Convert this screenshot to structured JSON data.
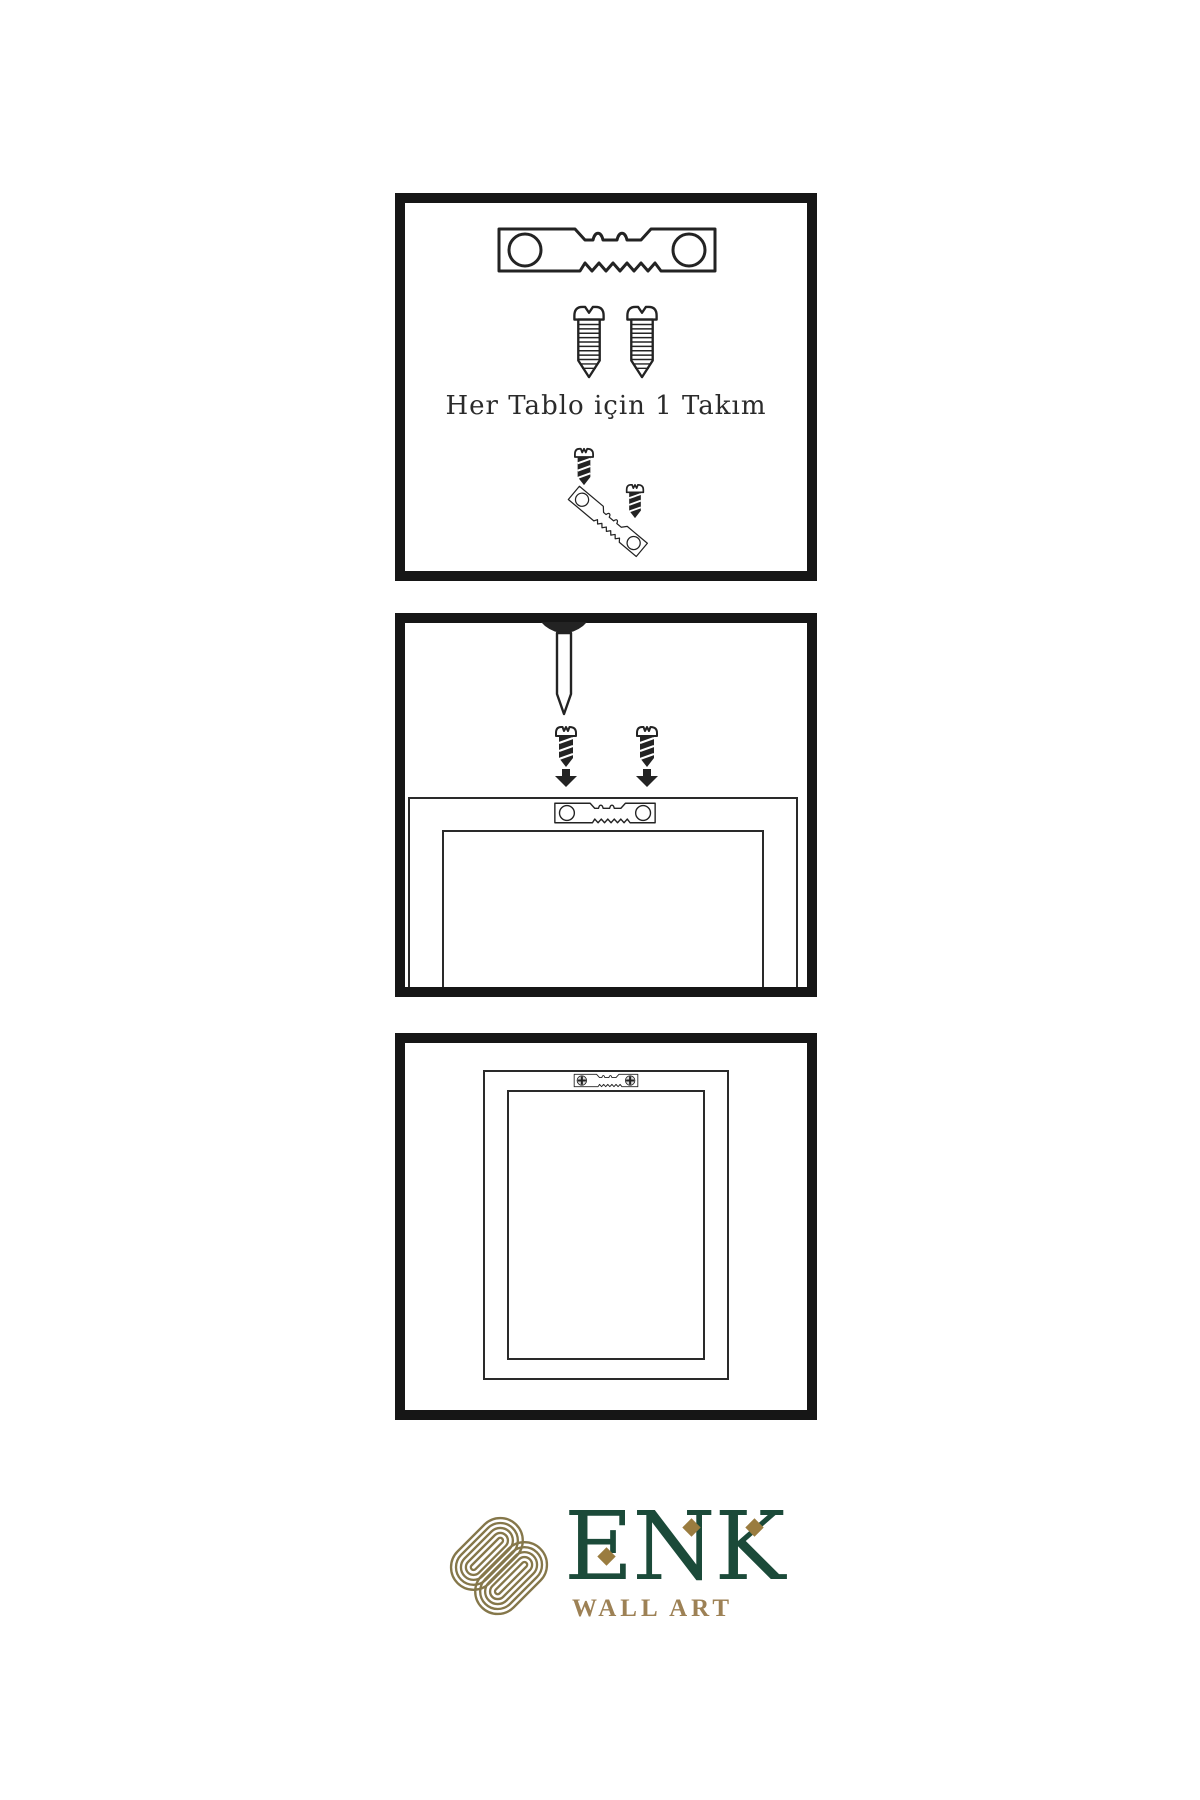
{
  "document": {
    "background_color": "#ffffff",
    "line_color": "#232323",
    "type": "wall-art hanging instruction sheet"
  },
  "panel_1": {
    "caption": "Her Tablo için 1 Takım",
    "icons": [
      "sawtooth-hanger-icon",
      "screw-icon",
      "screw-icon",
      "screw-icon",
      "angled-sawtooth-hanger-icon",
      "screw-icon"
    ]
  },
  "panel_2": {
    "icons": [
      "wall-nail-icon",
      "screw-icon",
      "screw-icon",
      "down-arrow-icon",
      "down-arrow-icon",
      "frame-back-icon",
      "sawtooth-hanger-icon"
    ]
  },
  "panel_3": {
    "icons": [
      "framed-picture-icon",
      "mounted-sawtooth-hanger-icon"
    ]
  },
  "brand": {
    "name": "ENK",
    "tagline": "WALL ART",
    "logo_icon": "interlocking-knot-icon",
    "colors": {
      "brand_green": "#1b4a39",
      "brand_gold": "#9d8155",
      "knot_gold": "#85774a",
      "diamond_gold": "#9a7c3f"
    }
  }
}
